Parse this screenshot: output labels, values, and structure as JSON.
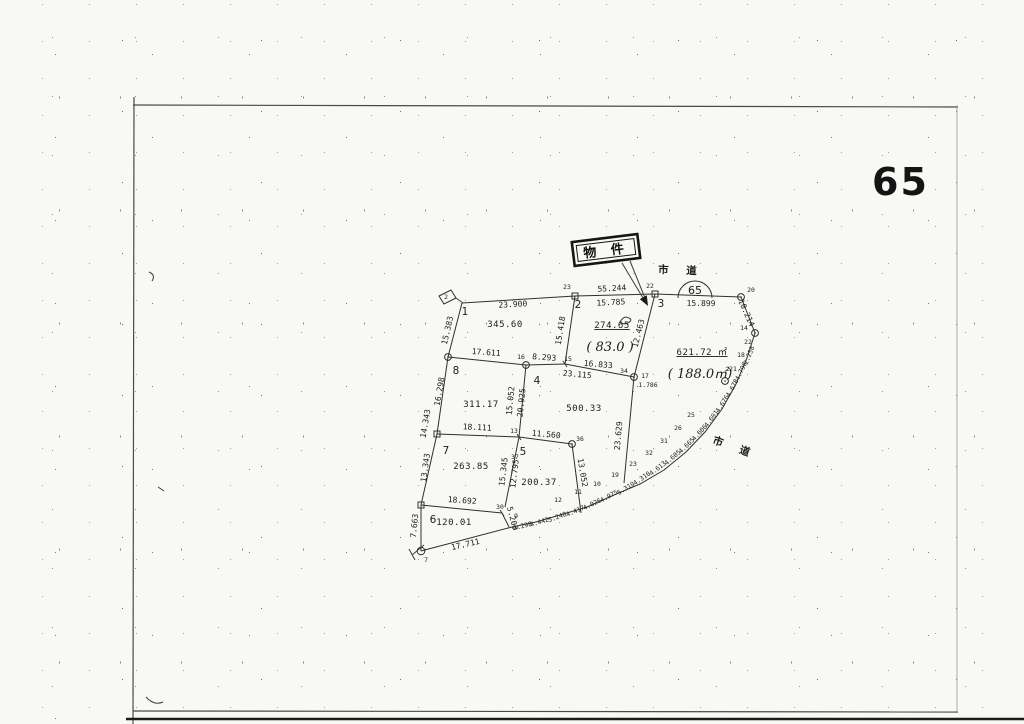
{
  "header": {
    "sheet_number": "65"
  },
  "callout": {
    "text": "物 件"
  },
  "route_badge": {
    "text": "65"
  },
  "roads": [
    {
      "text": "市 道"
    },
    {
      "text": "市 道"
    }
  ],
  "map": {
    "edges": [
      [
        462,
        303,
        575,
        296
      ],
      [
        575,
        296,
        655,
        294
      ],
      [
        655,
        294,
        741,
        297
      ],
      [
        741,
        297,
        755,
        333
      ],
      [
        462,
        303,
        448,
        357
      ],
      [
        448,
        357,
        437,
        434
      ],
      [
        437,
        434,
        421,
        505
      ],
      [
        421,
        505,
        421,
        551
      ],
      [
        421,
        551,
        512,
        527
      ],
      [
        448,
        357,
        526,
        365
      ],
      [
        526,
        365,
        565,
        364
      ],
      [
        565,
        364,
        634,
        377
      ],
      [
        575,
        296,
        565,
        364
      ],
      [
        655,
        294,
        634,
        377
      ],
      [
        526,
        365,
        519,
        437
      ],
      [
        437,
        434,
        519,
        437
      ],
      [
        519,
        437,
        572,
        444
      ],
      [
        634,
        377,
        624,
        483
      ],
      [
        572,
        444,
        581,
        513
      ],
      [
        519,
        437,
        505,
        507
      ],
      [
        421,
        505,
        502,
        513
      ],
      [
        502,
        513,
        509,
        527
      ]
    ],
    "curve": [
      [
        755,
        333
      ],
      [
        747,
        358
      ],
      [
        736,
        384
      ],
      [
        722,
        409
      ],
      [
        705,
        432
      ],
      [
        686,
        452
      ],
      [
        664,
        470
      ],
      [
        640,
        484
      ],
      [
        614,
        495
      ],
      [
        587,
        507
      ],
      [
        560,
        515
      ],
      [
        536,
        522
      ],
      [
        512,
        527
      ]
    ],
    "markers": [
      {
        "k": "sq",
        "x": 575,
        "y": 296
      },
      {
        "k": "sq",
        "x": 655,
        "y": 294
      },
      {
        "k": "ci",
        "x": 741,
        "y": 297
      },
      {
        "k": "ci",
        "x": 755,
        "y": 333
      },
      {
        "k": "ci",
        "x": 725,
        "y": 381
      },
      {
        "k": "ci",
        "x": 448,
        "y": 357
      },
      {
        "k": "ci",
        "x": 526,
        "y": 365
      },
      {
        "k": "ci",
        "x": 634,
        "y": 377
      },
      {
        "k": "ci",
        "x": 572,
        "y": 444
      },
      {
        "k": "sq",
        "x": 437,
        "y": 434
      },
      {
        "k": "sq",
        "x": 421,
        "y": 505
      },
      {
        "k": "st",
        "x": 421,
        "y": 551
      },
      {
        "k": "st2",
        "x": 452,
        "y": 299
      },
      {
        "k": "tk",
        "x": 519,
        "y": 437
      },
      {
        "k": "tk",
        "x": 565,
        "y": 364
      },
      {
        "k": "tk",
        "x": 502,
        "y": 513
      }
    ],
    "labels": [
      {
        "t": "23.900",
        "x": 513,
        "y": 307,
        "r": -3,
        "c": "m"
      },
      {
        "t": "55.244",
        "x": 612,
        "y": 291,
        "r": -3,
        "c": "m"
      },
      {
        "t": "15.785",
        "x": 611,
        "y": 305,
        "r": -3,
        "c": "m"
      },
      {
        "t": "15.899",
        "x": 701,
        "y": 306,
        "r": 1,
        "c": "m"
      },
      {
        "t": "10.214",
        "x": 744,
        "y": 314,
        "r": 66,
        "c": "m"
      },
      {
        "t": "15.383",
        "x": 450,
        "y": 331,
        "r": -77,
        "c": "m"
      },
      {
        "t": "16.298",
        "x": 442,
        "y": 392,
        "r": -80,
        "c": "m"
      },
      {
        "t": "14.343",
        "x": 428,
        "y": 424,
        "r": -80,
        "c": "m"
      },
      {
        "t": "13.343",
        "x": 428,
        "y": 468,
        "r": -82,
        "c": "m"
      },
      {
        "t": "7.663",
        "x": 417,
        "y": 526,
        "r": -84,
        "c": "m"
      },
      {
        "t": "17.611",
        "x": 486,
        "y": 355,
        "r": 4,
        "c": "m"
      },
      {
        "t": "8.293",
        "x": 544,
        "y": 360,
        "r": 4,
        "c": "m"
      },
      {
        "t": "16.833",
        "x": 598,
        "y": 367,
        "r": 5,
        "c": "m"
      },
      {
        "t": "23.115",
        "x": 577,
        "y": 377,
        "r": 5,
        "c": "m"
      },
      {
        "t": "15.418",
        "x": 563,
        "y": 331,
        "r": -81,
        "c": "m"
      },
      {
        "t": "12.463",
        "x": 641,
        "y": 334,
        "r": -76,
        "c": "m"
      },
      {
        "t": "1.786",
        "x": 648,
        "y": 387,
        "r": 0,
        "c": "s"
      },
      {
        "t": "15.052",
        "x": 513,
        "y": 401,
        "r": -84,
        "c": "m"
      },
      {
        "t": "20.925",
        "x": 524,
        "y": 403,
        "r": -84,
        "c": "m"
      },
      {
        "t": "18.111",
        "x": 477,
        "y": 430,
        "r": 3,
        "c": "m"
      },
      {
        "t": "11.560",
        "x": 546,
        "y": 437,
        "r": 5,
        "c": "m"
      },
      {
        "t": "15.345",
        "x": 506,
        "y": 472,
        "r": -83,
        "c": "m"
      },
      {
        "t": "12.795",
        "x": 517,
        "y": 474,
        "r": -83,
        "c": "m"
      },
      {
        "t": "13.052",
        "x": 580,
        "y": 473,
        "r": 80,
        "c": "m"
      },
      {
        "t": "18.692",
        "x": 462,
        "y": 503,
        "r": 4,
        "c": "m"
      },
      {
        "t": "5.203",
        "x": 510,
        "y": 519,
        "r": 75,
        "c": "m"
      },
      {
        "t": "17.711",
        "x": 466,
        "y": 547,
        "r": -13,
        "c": "m"
      },
      {
        "t": "23.629",
        "x": 621,
        "y": 436,
        "r": -85,
        "c": "m"
      },
      {
        "t": "0.298",
        "x": 523,
        "y": 528,
        "r": -14,
        "c": "s"
      },
      {
        "t": "4.442",
        "x": 540,
        "y": 524,
        "r": -17,
        "c": "s"
      },
      {
        "t": "5.248",
        "x": 558,
        "y": 519,
        "r": -20,
        "c": "s"
      },
      {
        "t": "4.417",
        "x": 576,
        "y": 513,
        "r": -23,
        "c": "s"
      },
      {
        "t": "4.026",
        "x": 593,
        "y": 506,
        "r": -26,
        "c": "s"
      },
      {
        "t": "4.975",
        "x": 610,
        "y": 498,
        "r": -29,
        "c": "s"
      },
      {
        "t": "5.310",
        "x": 627,
        "y": 490,
        "r": -32,
        "c": "s"
      },
      {
        "t": "4.310",
        "x": 643,
        "y": 480,
        "r": -35,
        "c": "s"
      },
      {
        "t": "4.613",
        "x": 659,
        "y": 470,
        "r": -38,
        "c": "s"
      },
      {
        "t": "4.605",
        "x": 674,
        "y": 459,
        "r": -41,
        "c": "s"
      },
      {
        "t": "4.665",
        "x": 688,
        "y": 447,
        "r": -44,
        "c": "s"
      },
      {
        "t": "4.606",
        "x": 701,
        "y": 434,
        "r": -48,
        "c": "s"
      },
      {
        "t": "4.601",
        "x": 713,
        "y": 420,
        "r": -53,
        "c": "s"
      },
      {
        "t": "4.676",
        "x": 724,
        "y": 405,
        "r": -57,
        "c": "s"
      },
      {
        "t": "4.678",
        "x": 734,
        "y": 389,
        "r": -61,
        "c": "s"
      },
      {
        "t": "4.796",
        "x": 743,
        "y": 372,
        "r": -65,
        "c": "s"
      },
      {
        "t": "2.258",
        "x": 751,
        "y": 356,
        "r": -68,
        "c": "s"
      },
      {
        "t": "2",
        "x": 446,
        "y": 299,
        "c": "p"
      },
      {
        "t": "23",
        "x": 567,
        "y": 289,
        "c": "p"
      },
      {
        "t": "22",
        "x": 650,
        "y": 288,
        "c": "p"
      },
      {
        "t": "20",
        "x": 751,
        "y": 292,
        "c": "p"
      },
      {
        "t": "14",
        "x": 744,
        "y": 330,
        "c": "p"
      },
      {
        "t": "16",
        "x": 521,
        "y": 359,
        "c": "p"
      },
      {
        "t": "15",
        "x": 568,
        "y": 361,
        "c": "p"
      },
      {
        "t": "34",
        "x": 624,
        "y": 373,
        "c": "p"
      },
      {
        "t": "17",
        "x": 645,
        "y": 378,
        "c": "p"
      },
      {
        "t": "13",
        "x": 514,
        "y": 433,
        "c": "p"
      },
      {
        "t": "37",
        "x": 515,
        "y": 459,
        "c": "p"
      },
      {
        "t": "36",
        "x": 580,
        "y": 441,
        "c": "p"
      },
      {
        "t": "30",
        "x": 500,
        "y": 509,
        "c": "p"
      },
      {
        "t": "7",
        "x": 426,
        "y": 562,
        "c": "p"
      },
      {
        "t": "9",
        "x": 516,
        "y": 518,
        "c": "p"
      },
      {
        "t": "12",
        "x": 558,
        "y": 502,
        "c": "p"
      },
      {
        "t": "11",
        "x": 578,
        "y": 494,
        "c": "p"
      },
      {
        "t": "10",
        "x": 597,
        "y": 486,
        "c": "p"
      },
      {
        "t": "19",
        "x": 615,
        "y": 477,
        "c": "p"
      },
      {
        "t": "23",
        "x": 633,
        "y": 466,
        "c": "p"
      },
      {
        "t": "32",
        "x": 649,
        "y": 455,
        "c": "p"
      },
      {
        "t": "31",
        "x": 664,
        "y": 443,
        "c": "p"
      },
      {
        "t": "26",
        "x": 678,
        "y": 430,
        "c": "p"
      },
      {
        "t": "25",
        "x": 691,
        "y": 417,
        "c": "p"
      },
      {
        "t": "21",
        "x": 733,
        "y": 371,
        "c": "p"
      },
      {
        "t": "18",
        "x": 741,
        "y": 357,
        "c": "p"
      },
      {
        "t": "22",
        "x": 748,
        "y": 344,
        "c": "p"
      },
      {
        "t": "1",
        "x": 465,
        "y": 315,
        "c": "l"
      },
      {
        "t": "2",
        "x": 578,
        "y": 308,
        "c": "l"
      },
      {
        "t": "3",
        "x": 661,
        "y": 307,
        "c": "l"
      },
      {
        "t": "8",
        "x": 456,
        "y": 374,
        "c": "l"
      },
      {
        "t": "4",
        "x": 537,
        "y": 384,
        "c": "l"
      },
      {
        "t": "7",
        "x": 446,
        "y": 454,
        "c": "l"
      },
      {
        "t": "5",
        "x": 523,
        "y": 455,
        "c": "l"
      },
      {
        "t": "6",
        "x": 433,
        "y": 523,
        "c": "l"
      },
      {
        "t": "345.60",
        "x": 505,
        "y": 327,
        "c": "a"
      },
      {
        "t": "274.65",
        "x": 612,
        "y": 328,
        "c": "au"
      },
      {
        "t": "( 83.0 )",
        "x": 610,
        "y": 351,
        "c": "h"
      },
      {
        "t": "621.72 ㎡",
        "x": 702,
        "y": 355,
        "c": "au"
      },
      {
        "t": "( 188.0㎡)",
        "x": 700,
        "y": 378,
        "c": "h"
      },
      {
        "t": "311.17",
        "x": 481,
        "y": 407,
        "c": "a"
      },
      {
        "t": "500.33",
        "x": 584,
        "y": 411,
        "c": "a"
      },
      {
        "t": "263.85",
        "x": 471,
        "y": 469,
        "c": "a"
      },
      {
        "t": "200.37",
        "x": 539,
        "y": 485,
        "c": "a"
      },
      {
        "t": "120.01",
        "x": 454,
        "y": 525,
        "c": "a"
      }
    ]
  }
}
